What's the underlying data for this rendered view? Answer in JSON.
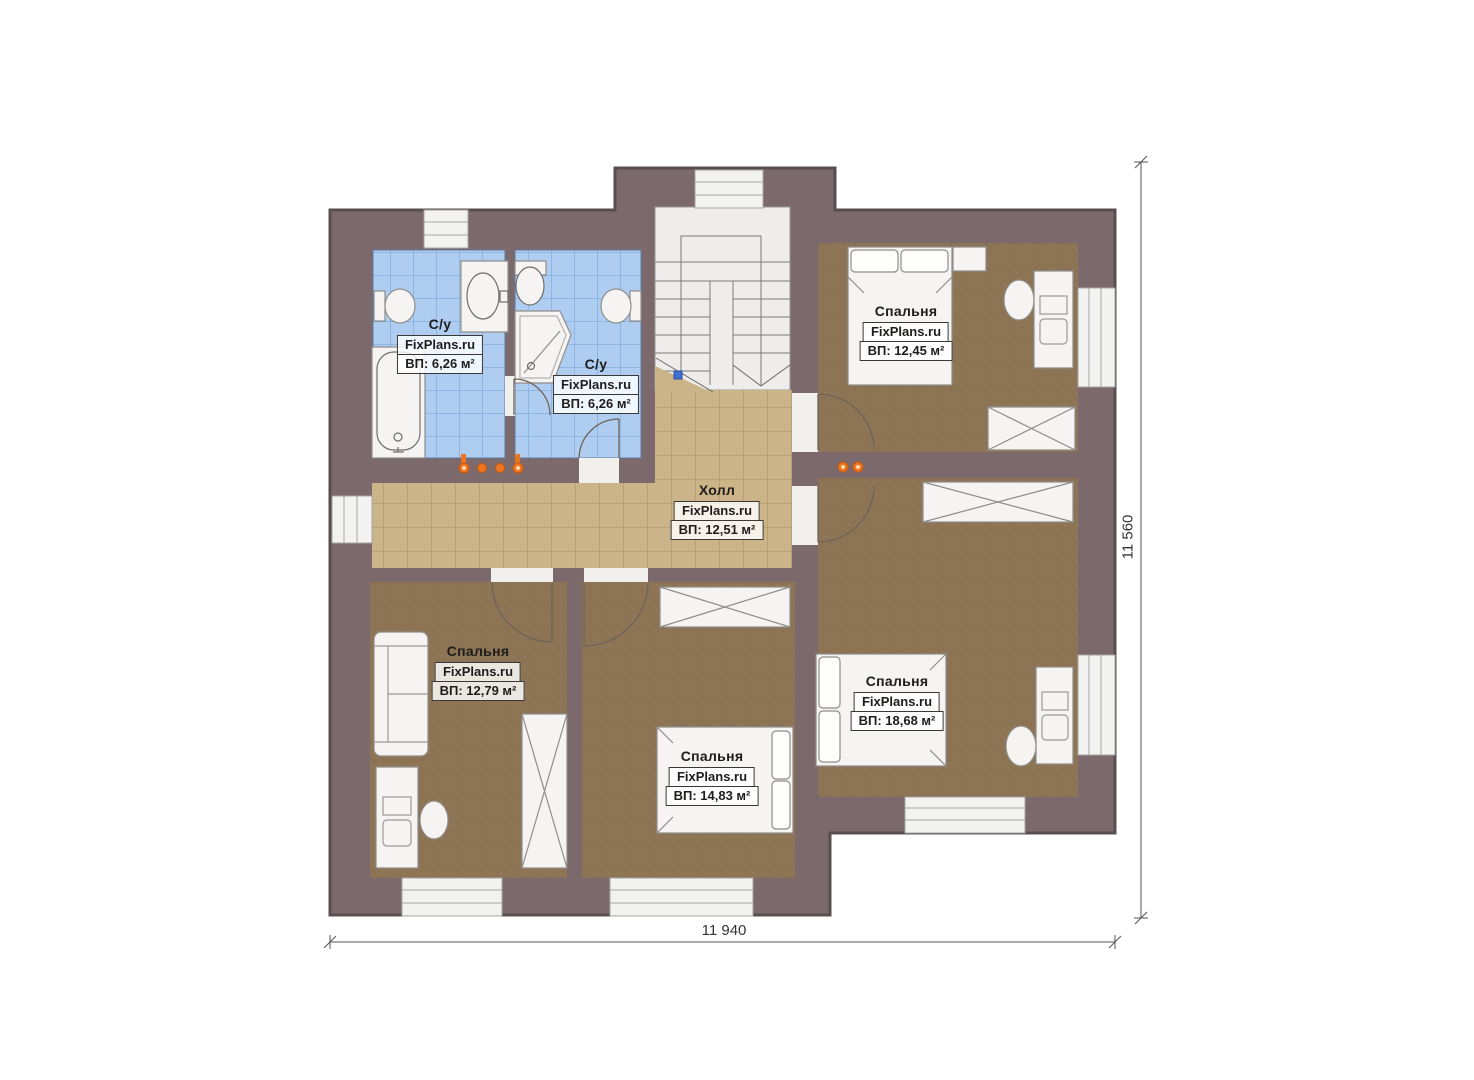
{
  "plan": {
    "rooms": [
      {
        "id": "bathroom-left",
        "name": "С/у",
        "watermark": "FixPlans.ru",
        "area": "ВП: 6,26 м²"
      },
      {
        "id": "bathroom-right",
        "name": "С/у",
        "watermark": "FixPlans.ru",
        "area": "ВП: 6,26 м²"
      },
      {
        "id": "bedroom-top-right",
        "name": "Спальня",
        "watermark": "FixPlans.ru",
        "area": "ВП: 12,45 м²"
      },
      {
        "id": "hall",
        "name": "Холл",
        "watermark": "FixPlans.ru",
        "area": "ВП: 12,51 м²"
      },
      {
        "id": "bedroom-bottom-left",
        "name": "Спальня",
        "watermark": "FixPlans.ru",
        "area": "ВП: 12,79 м²"
      },
      {
        "id": "bedroom-bottom-middle",
        "name": "Спальня",
        "watermark": "FixPlans.ru",
        "area": "ВП: 14,83 м²"
      },
      {
        "id": "bedroom-bottom-right",
        "name": "Спальня",
        "watermark": "FixPlans.ru",
        "area": "ВП: 18,68 м²"
      }
    ],
    "dimensions": {
      "width": "11 940",
      "height": "11 560"
    }
  },
  "colors": {
    "wall": "#7b696b",
    "wall_outline": "#584e50",
    "carpet": "#8c7455",
    "hall_tile": "#ccb489",
    "hall_tile_grid": "#a68e61",
    "bath_tile": "#aecdf1",
    "bath_tile_grid": "#70a0d4",
    "fixture_white": "#f5f4f2",
    "stairs": "#eeedeb",
    "accent_orange": "#ed7420",
    "dim_color": "#555555",
    "text_color": "#1f1d1c",
    "handle_blue": "#3f6fd1"
  }
}
